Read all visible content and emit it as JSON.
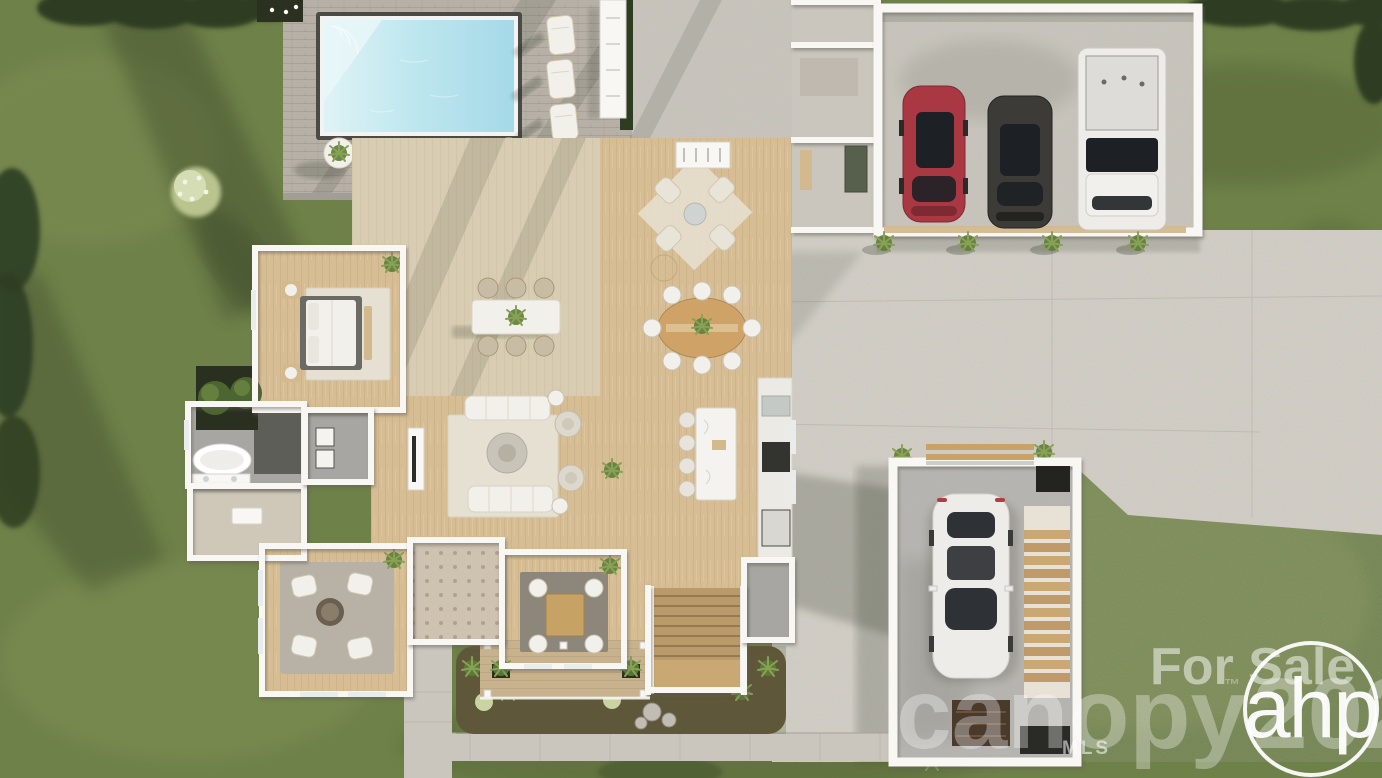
{
  "watermark": {
    "for_sale": "For Sale",
    "brand": "canopy",
    "trademark": "™",
    "year": "2025",
    "mls": "MLS",
    "logo": "ahp"
  },
  "scene": {
    "type": "aerial-dollhouse-3d-render",
    "elements": [
      "lawn",
      "swimming-pool",
      "pool-patio",
      "lounge-chairs",
      "main-house-floorplan",
      "attached-garage",
      "detached-garage",
      "driveway",
      "sidewalk",
      "front-landscaping"
    ],
    "lounge_chair_count": 3,
    "garage_vehicles": [
      "red-sedan",
      "dark-suv",
      "white-pickup"
    ],
    "detached_garage_vehicles": [
      "white-sedan"
    ]
  },
  "colors": {
    "grass": "#7b8850",
    "grass_light": "#9aa565",
    "grass_dark": "#46552b",
    "tree": "#2e3d22",
    "tree_light": "#5d7136",
    "shadow": "#262d1c",
    "patio": "#b6b0a7",
    "concrete": "#d5d1c9",
    "concrete2": "#cac6be",
    "pool_frame": "#4b4a45",
    "pool_water": "#a5d9e8",
    "pool_light": "#dff3f6",
    "wood": "#d7bd93",
    "deck": "#d8ccb2",
    "porchwood": "#c7b28d",
    "wall": "#f8f7f4",
    "tile": "#a7a6a2",
    "tile_dark": "#5e5e59",
    "carpet": "#cfc8b9",
    "rug_light": "#e6e0d2",
    "rug_gray": "#b7b1a6",
    "rug_dark": "#8d867a",
    "foyer": "#cec2b1",
    "mulch": "#5c4836",
    "rock": "#c2bdb4",
    "stair_wood": "#c9a873",
    "tan": "#d2b98e",
    "glass": "#1d2125",
    "white_furn": "#f2f0ea",
    "car_red": "#a93842",
    "car_dark": "#3c3b38",
    "car_white": "#edece9",
    "watermark": "#ffffff"
  }
}
